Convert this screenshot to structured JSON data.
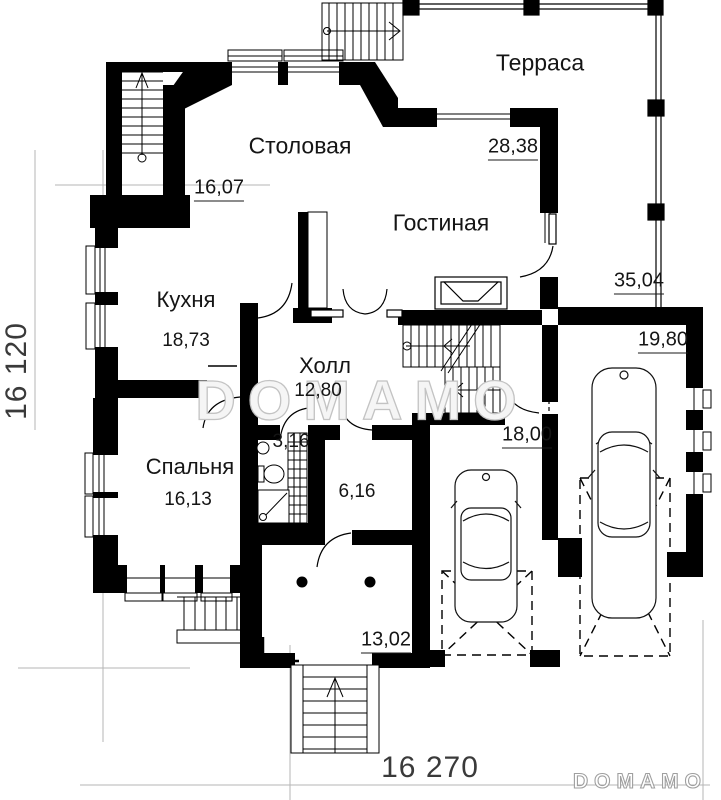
{
  "texts": {
    "terrace": "Терраса",
    "dining": "Столовая",
    "dining_area": "16,07",
    "living": "Гостиная",
    "living_area": "28,38",
    "kitchen": "Кухня",
    "kitchen_area": "18,73",
    "hall": "Холл",
    "hall_area": "12,80",
    "terrace_area": "35,04",
    "garage_area": "19,80",
    "carport_area": "18,00",
    "bedroom": "Спальня",
    "bedroom_area": "16,13",
    "bathroom_area": "3,16",
    "corridor_area": "6,16",
    "porch_area": "13,02",
    "dim_height": "16 120",
    "dim_width": "16 270",
    "watermark": "DOMAMO",
    "brand": "DOMAMO"
  },
  "colors": {
    "walls": "#000000",
    "reference_lines": "#b5b5b5",
    "text": "#151515",
    "watermark_outline": "#c3c3c3",
    "brand_outline": "#9f9f9f"
  }
}
